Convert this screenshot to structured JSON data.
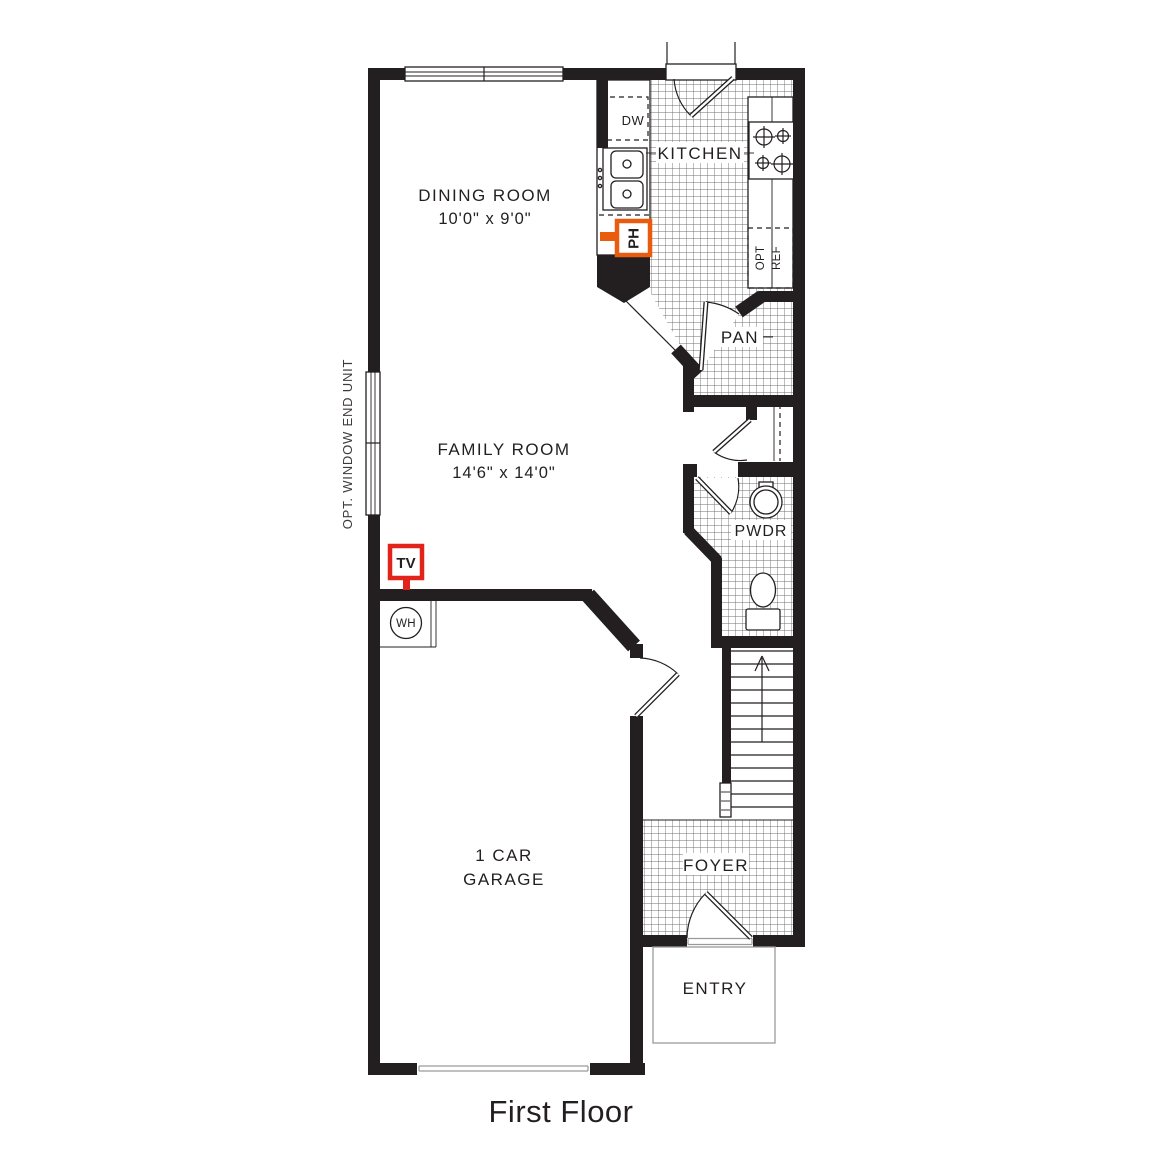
{
  "title": "First Floor",
  "annotations": {
    "window_note": "OPT. WINDOW END UNIT"
  },
  "rooms": {
    "dining": {
      "name": "DINING ROOM",
      "dims": "10'0\" x 9'0\""
    },
    "kitchen": {
      "name": "KITCHEN"
    },
    "family": {
      "name": "FAMILY ROOM",
      "dims": "14'6\" x 14'0\""
    },
    "pantry": {
      "name": "PAN"
    },
    "powder": {
      "name": "PWDR"
    },
    "foyer": {
      "name": "FOYER"
    },
    "entry": {
      "name": "ENTRY"
    },
    "garage": {
      "line1": "1 CAR",
      "line2": "GARAGE"
    }
  },
  "fixtures": {
    "dishwasher": "DW",
    "fridge_line1": "OPT",
    "fridge_line2": "REF",
    "phone_jack": "PH",
    "tv_jack": "TV",
    "water_heater": "WH"
  },
  "colors": {
    "wall": "#231f20",
    "tv-red": "#e2231a",
    "ph-orange": "#e95b0e",
    "tile-line": "#6f6f6f"
  }
}
